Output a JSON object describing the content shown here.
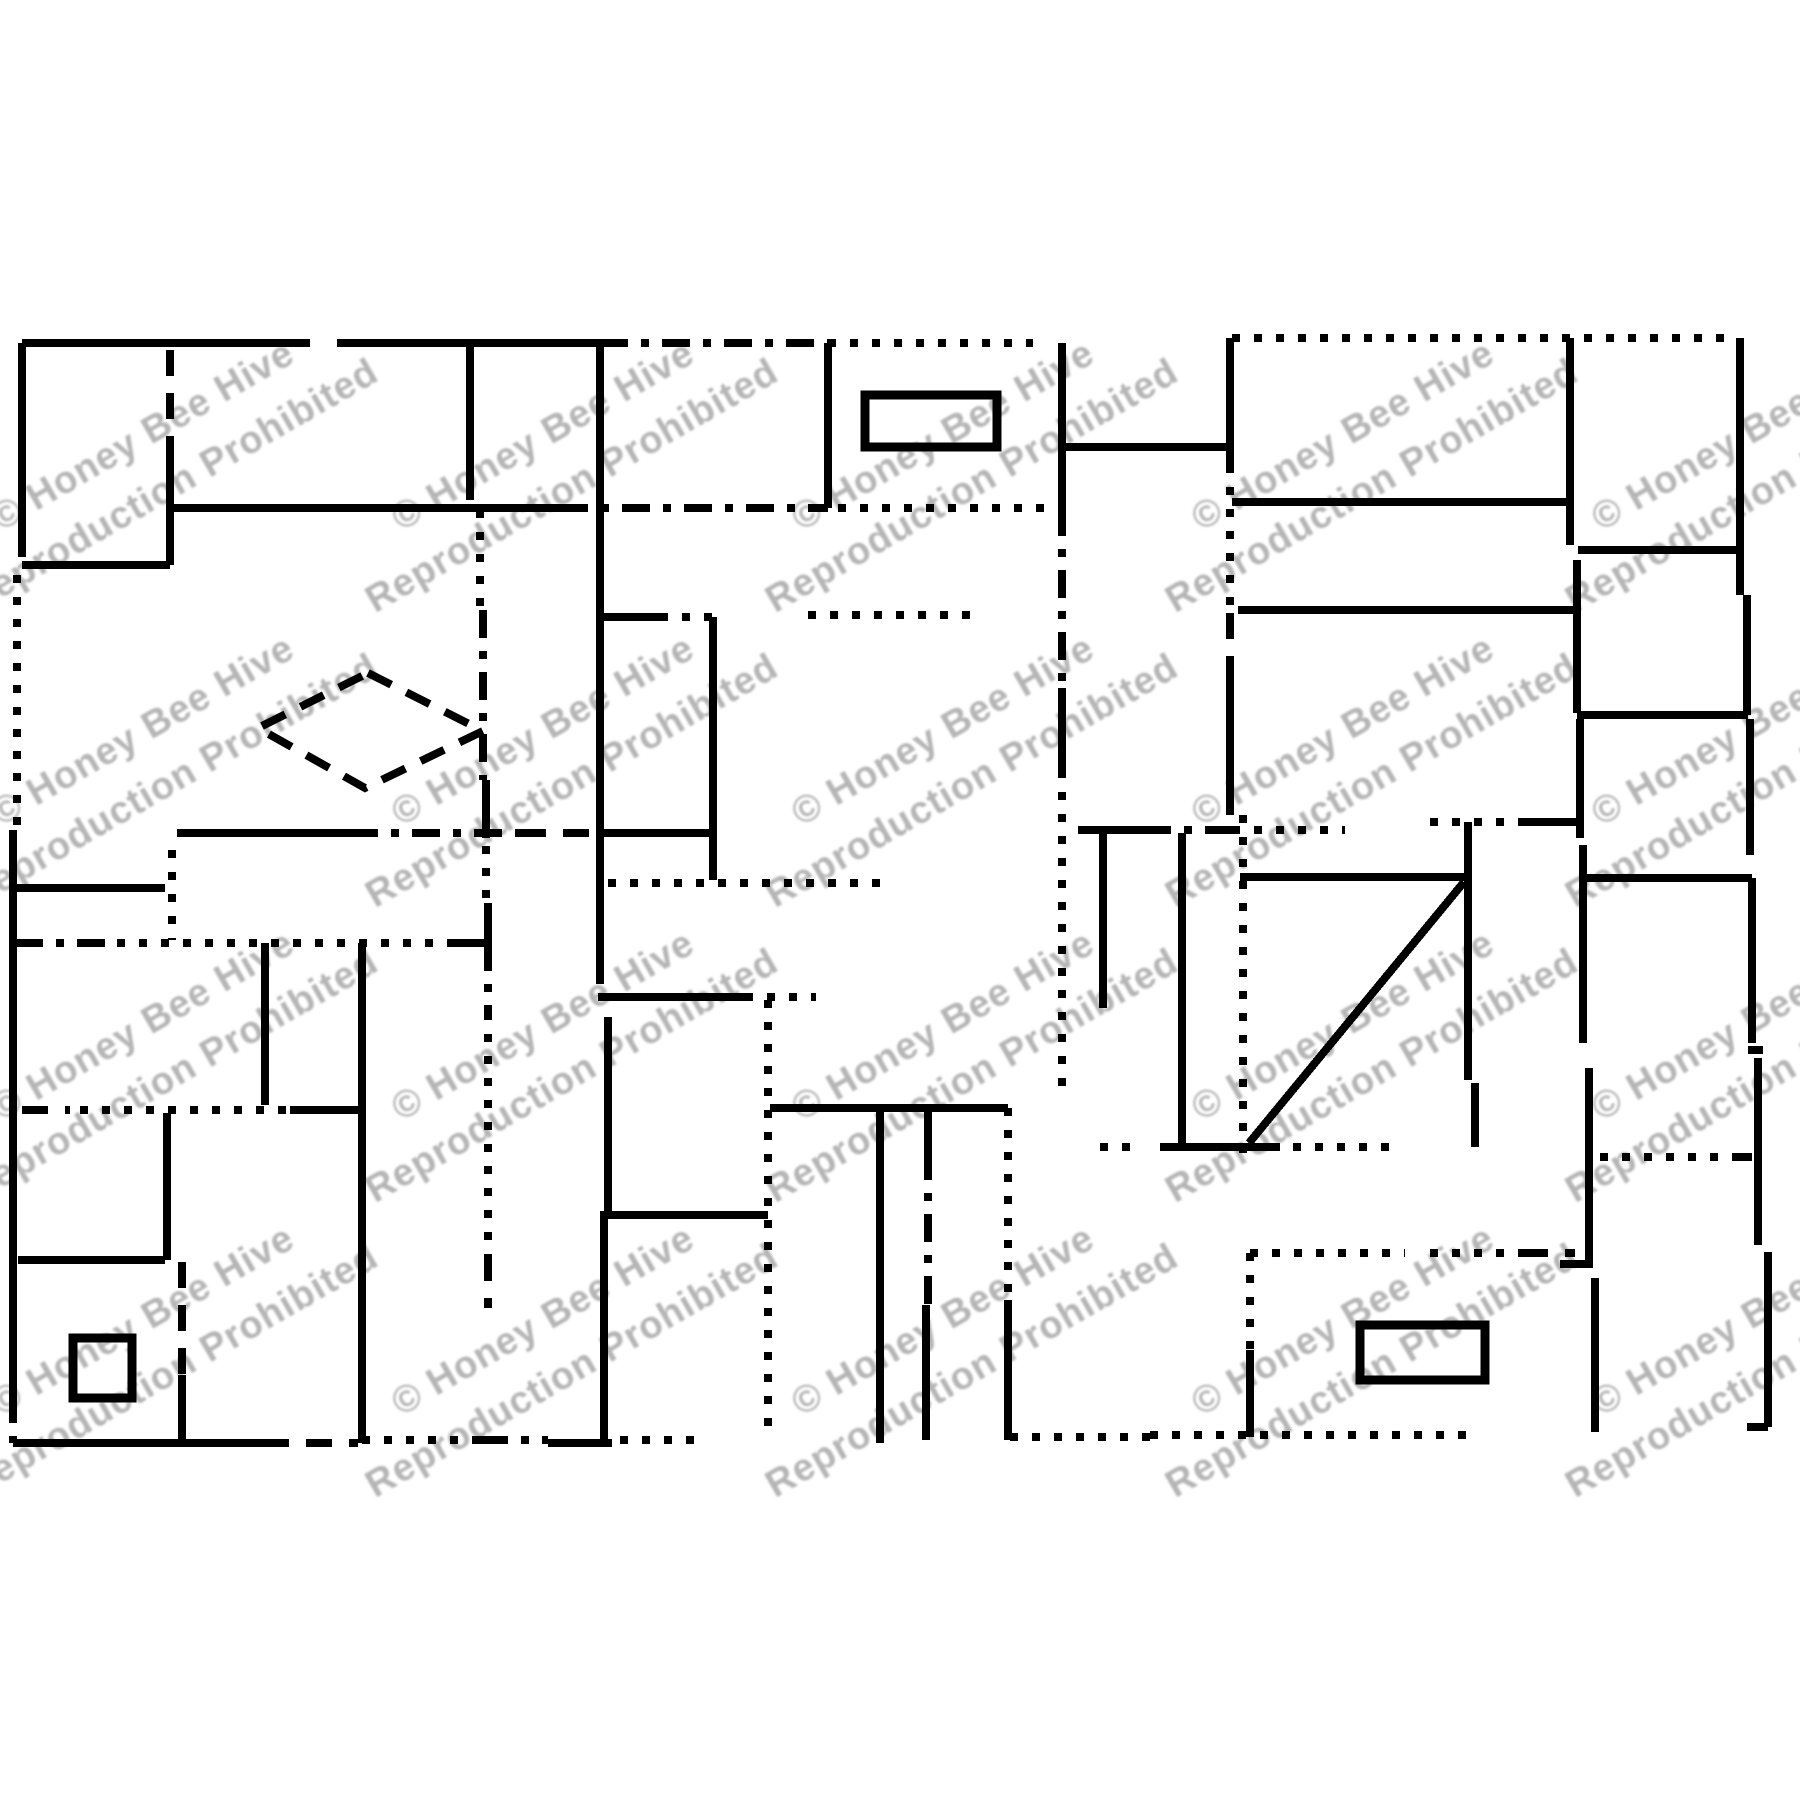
{
  "page": {
    "background": "#ffffff",
    "canvas_width": 1800,
    "canvas_height": 1800,
    "ink_color": "#000000",
    "stroke_width": 8,
    "rect_stroke_width": 9
  },
  "watermark": {
    "line1": "© Honey Bee Hive",
    "line2": "Reproduction Prohibited",
    "color": "#b5b5b5",
    "font_size": 38,
    "rotation_deg": -30,
    "line1_dy": -22,
    "line2_dy": 36,
    "blur": 1,
    "columns": [
      160,
      560,
      960,
      1360,
      1760
    ],
    "rows": [
      465,
      760,
      1055,
      1350
    ]
  },
  "dash_styles": {
    "solid": "",
    "dash": "26 17",
    "dot": "8 14",
    "dashdot": "28 13 8 13"
  },
  "pattern": {
    "segments": [
      [
        22,
        343,
        310,
        343,
        "solid"
      ],
      [
        337,
        343,
        600,
        343,
        "solid"
      ],
      [
        600,
        343,
        828,
        343,
        "dashdot"
      ],
      [
        828,
        343,
        1033,
        343,
        "dot"
      ],
      [
        1232,
        338,
        1733,
        338,
        "dot"
      ],
      [
        22,
        343,
        22,
        557,
        "solid"
      ],
      [
        17,
        575,
        17,
        830,
        "dot"
      ],
      [
        13,
        830,
        13,
        1395,
        "solid"
      ],
      [
        13,
        1395,
        13,
        1443,
        "dashdot"
      ],
      [
        170,
        350,
        170,
        448,
        "dash"
      ],
      [
        170,
        448,
        170,
        565,
        "solid"
      ],
      [
        22,
        565,
        170,
        565,
        "solid"
      ],
      [
        470,
        343,
        470,
        500,
        "solid"
      ],
      [
        480,
        510,
        480,
        610,
        "dot"
      ],
      [
        483,
        610,
        483,
        780,
        "dashdot"
      ],
      [
        486,
        780,
        486,
        838,
        "solid"
      ],
      [
        486,
        846,
        486,
        903,
        "dot"
      ],
      [
        488,
        903,
        488,
        943,
        "solid"
      ],
      [
        488,
        943,
        488,
        1012,
        "dashdot"
      ],
      [
        488,
        1012,
        488,
        1255,
        "dot"
      ],
      [
        488,
        1255,
        488,
        1308,
        "dash"
      ],
      [
        173,
        508,
        560,
        508,
        "solid"
      ],
      [
        560,
        508,
        828,
        508,
        "dashdot"
      ],
      [
        838,
        508,
        1058,
        508,
        "dot"
      ],
      [
        828,
        343,
        828,
        508,
        "solid"
      ],
      [
        600,
        343,
        600,
        958,
        "solid"
      ],
      [
        600,
        958,
        600,
        997,
        "dash"
      ],
      [
        1062,
        343,
        1062,
        508,
        "solid"
      ],
      [
        1062,
        508,
        1062,
        688,
        "dashdot"
      ],
      [
        1062,
        688,
        1062,
        770,
        "solid"
      ],
      [
        1062,
        770,
        1062,
        1095,
        "dot"
      ],
      [
        1062,
        447,
        1230,
        447,
        "solid"
      ],
      [
        1230,
        338,
        1230,
        465,
        "solid"
      ],
      [
        1230,
        465,
        1230,
        613,
        "dot"
      ],
      [
        1230,
        613,
        1230,
        658,
        "dash"
      ],
      [
        1230,
        658,
        1230,
        815,
        "solid"
      ],
      [
        1243,
        815,
        1243,
        1160,
        "dot"
      ],
      [
        600,
        617,
        660,
        617,
        "solid"
      ],
      [
        660,
        617,
        713,
        617,
        "dot"
      ],
      [
        808,
        615,
        978,
        615,
        "dot"
      ],
      [
        713,
        617,
        713,
        880,
        "solid"
      ],
      [
        608,
        883,
        890,
        883,
        "dot"
      ],
      [
        177,
        833,
        350,
        833,
        "solid"
      ],
      [
        350,
        833,
        520,
        833,
        "dashdot"
      ],
      [
        520,
        833,
        595,
        833,
        "dash"
      ],
      [
        600,
        833,
        710,
        833,
        "solid"
      ],
      [
        15,
        888,
        165,
        888,
        "solid"
      ],
      [
        172,
        850,
        172,
        940,
        "dot"
      ],
      [
        15,
        943,
        110,
        943,
        "dashdot"
      ],
      [
        117,
        943,
        448,
        943,
        "dot"
      ],
      [
        448,
        943,
        488,
        943,
        "solid"
      ],
      [
        265,
        943,
        265,
        1105,
        "solid"
      ],
      [
        362,
        943,
        362,
        1443,
        "solid"
      ],
      [
        598,
        997,
        745,
        997,
        "solid"
      ],
      [
        745,
        997,
        816,
        997,
        "dot"
      ],
      [
        22,
        1110,
        70,
        1110,
        "dash"
      ],
      [
        80,
        1110,
        290,
        1110,
        "dot"
      ],
      [
        290,
        1110,
        362,
        1110,
        "solid"
      ],
      [
        167,
        1113,
        167,
        1260,
        "solid"
      ],
      [
        18,
        1260,
        165,
        1260,
        "solid"
      ],
      [
        182,
        1262,
        182,
        1375,
        "dash"
      ],
      [
        182,
        1375,
        182,
        1445,
        "solid"
      ],
      [
        600,
        1215,
        768,
        1215,
        "solid"
      ],
      [
        608,
        1017,
        608,
        1215,
        "solid"
      ],
      [
        604,
        1215,
        604,
        1443,
        "solid"
      ],
      [
        768,
        1000,
        768,
        1437,
        "dot"
      ],
      [
        770,
        1108,
        1008,
        1108,
        "solid"
      ],
      [
        880,
        1108,
        880,
        1443,
        "solid"
      ],
      [
        928,
        1108,
        928,
        1152,
        "solid"
      ],
      [
        928,
        1152,
        928,
        1305,
        "dashdot"
      ],
      [
        926,
        1305,
        926,
        1440,
        "solid"
      ],
      [
        1008,
        1108,
        1008,
        1300,
        "dot"
      ],
      [
        1008,
        1300,
        1008,
        1440,
        "solid"
      ],
      [
        1078,
        830,
        1143,
        830,
        "solid"
      ],
      [
        1143,
        830,
        1232,
        830,
        "dashdot"
      ],
      [
        1232,
        830,
        1345,
        830,
        "dot"
      ],
      [
        1103,
        833,
        1103,
        1008,
        "solid"
      ],
      [
        1182,
        833,
        1182,
        1147,
        "solid"
      ],
      [
        1240,
        877,
        1468,
        877,
        "solid"
      ],
      [
        1249,
        1143,
        1464,
        882,
        "solid"
      ],
      [
        1100,
        1147,
        1143,
        1147,
        "dot"
      ],
      [
        1160,
        1147,
        1280,
        1147,
        "solid"
      ],
      [
        1293,
        1147,
        1390,
        1147,
        "dot"
      ],
      [
        1468,
        822,
        1468,
        1080,
        "solid"
      ],
      [
        1475,
        1083,
        1475,
        1147,
        "solid"
      ],
      [
        1430,
        822,
        1520,
        822,
        "dot"
      ],
      [
        1520,
        822,
        1577,
        822,
        "solid"
      ],
      [
        1232,
        502,
        1572,
        502,
        "solid"
      ],
      [
        1238,
        610,
        1577,
        610,
        "solid"
      ],
      [
        1570,
        338,
        1570,
        545,
        "solid"
      ],
      [
        1577,
        560,
        1577,
        713,
        "solid"
      ],
      [
        1578,
        550,
        1740,
        550,
        "solid"
      ],
      [
        1740,
        338,
        1740,
        595,
        "solid"
      ],
      [
        1747,
        595,
        1747,
        715,
        "solid"
      ],
      [
        1577,
        715,
        1748,
        715,
        "solid"
      ],
      [
        1580,
        719,
        1580,
        838,
        "solid"
      ],
      [
        1583,
        845,
        1583,
        1043,
        "solid"
      ],
      [
        1585,
        878,
        1752,
        878,
        "solid"
      ],
      [
        1750,
        719,
        1750,
        855,
        "solid"
      ],
      [
        1752,
        878,
        1752,
        1043,
        "solid"
      ],
      [
        1748,
        1050,
        1763,
        1050,
        "solid"
      ],
      [
        1758,
        1058,
        1758,
        1245,
        "solid"
      ],
      [
        1768,
        1252,
        1768,
        1427,
        "solid"
      ],
      [
        1747,
        1427,
        1768,
        1427,
        "solid"
      ],
      [
        1589,
        1068,
        1589,
        1268,
        "solid"
      ],
      [
        1560,
        1264,
        1588,
        1264,
        "solid"
      ],
      [
        1595,
        1278,
        1595,
        1432,
        "solid"
      ],
      [
        1600,
        1157,
        1740,
        1157,
        "dot"
      ],
      [
        1740,
        1157,
        1752,
        1157,
        "solid"
      ],
      [
        1250,
        1253,
        1405,
        1253,
        "dot"
      ],
      [
        1430,
        1253,
        1522,
        1253,
        "dot"
      ],
      [
        1522,
        1253,
        1575,
        1253,
        "dash"
      ],
      [
        1250,
        1253,
        1250,
        1350,
        "dot"
      ],
      [
        1250,
        1350,
        1250,
        1437,
        "solid"
      ],
      [
        13,
        1443,
        263,
        1443,
        "solid"
      ],
      [
        263,
        1443,
        358,
        1443,
        "dash"
      ],
      [
        362,
        1440,
        480,
        1440,
        "dot"
      ],
      [
        480,
        1440,
        548,
        1440,
        "dashdot"
      ],
      [
        548,
        1443,
        612,
        1443,
        "solid"
      ],
      [
        620,
        1440,
        705,
        1440,
        "dot"
      ],
      [
        1010,
        1437,
        1150,
        1437,
        "dot"
      ],
      [
        1150,
        1435,
        1470,
        1435,
        "dot"
      ]
    ],
    "rects": [
      [
        865,
        395,
        132,
        52
      ],
      [
        1360,
        1325,
        125,
        55
      ],
      [
        73,
        1338,
        59,
        60
      ]
    ],
    "diamond": {
      "points": "368,673 483,731 365,788 258,728",
      "style": "dash"
    }
  }
}
